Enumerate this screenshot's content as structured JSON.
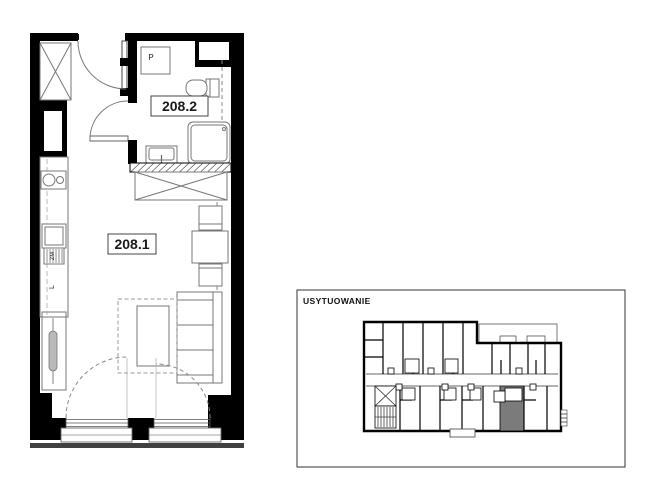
{
  "floor_plan": {
    "rooms": [
      {
        "number": "208.1"
      },
      {
        "number": "208.2"
      }
    ],
    "labels": {
      "washing_machine": "P",
      "kitchen_vent": "ZM",
      "fridge": "L"
    }
  },
  "location_panel": {
    "title": "USYTUOWANIE"
  },
  "colors": {
    "wall": "#000000",
    "furniture_line": "#777777",
    "highlight_unit": "#7b7b7b"
  }
}
